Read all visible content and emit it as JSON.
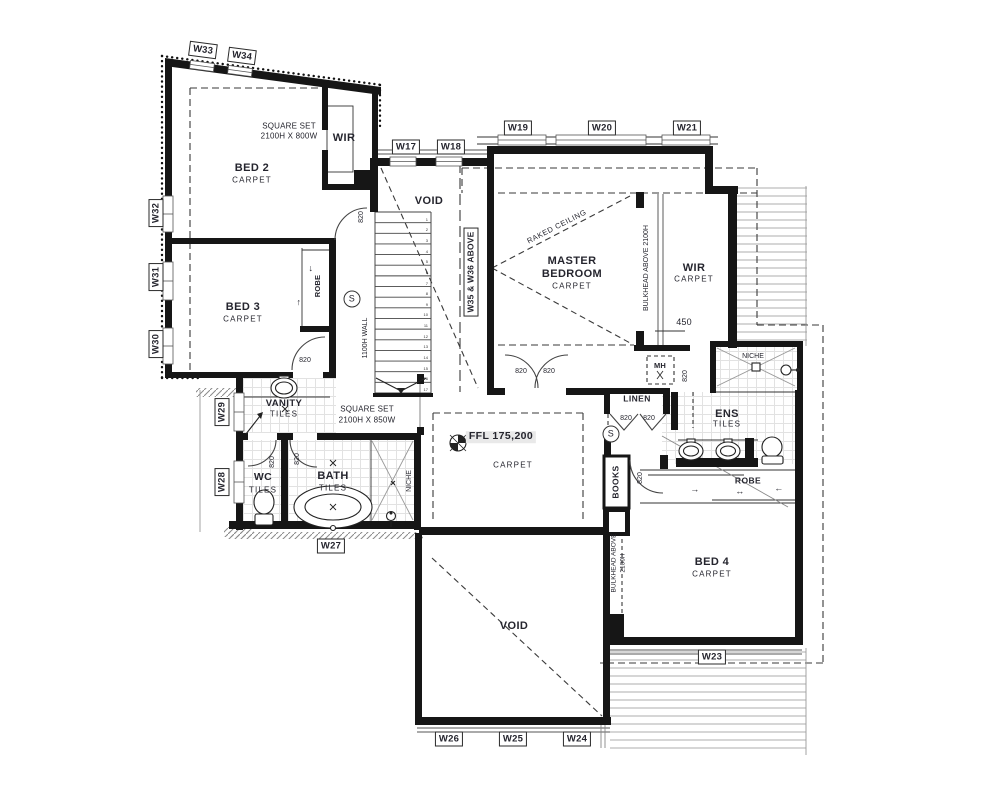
{
  "windows": {
    "w17": "W17",
    "w18": "W18",
    "w19": "W19",
    "w20": "W20",
    "w21": "W21",
    "w23": "W23",
    "w24": "W24",
    "w25": "W25",
    "w26": "W26",
    "w27": "W27",
    "w28": "W28",
    "w29": "W29",
    "w30": "W30",
    "w31": "W31",
    "w32": "W32",
    "w33": "W33",
    "w34": "W34",
    "w35_36_note": "W35 & W36 ABOVE"
  },
  "rooms": {
    "bed2": "BED 2",
    "bed3": "BED 3",
    "bed4": "BED 4",
    "master1": "MASTER",
    "master2": "BEDROOM",
    "wir": "WIR",
    "ens": "ENS",
    "bath": "BATH",
    "wc": "WC",
    "vanity": "VANITY",
    "linen": "LINEN",
    "robe": "ROBE",
    "books": "BOOKS",
    "niche": "NICHE",
    "void": "VOID",
    "mh": "MH"
  },
  "finishes": {
    "carpet": "CARPET",
    "tiles": "TILES"
  },
  "annotations": {
    "square_set_800_l1": "SQUARE SET",
    "square_set_800_l2": "2100H X 800W",
    "square_set_850_l1": "SQUARE SET",
    "square_set_850_l2": "2100H X 850W",
    "raked_ceiling": "RAKED CEILING",
    "bulkhead_full": "BULKHEAD ABOVE 2100H",
    "bulkhead_l1": "BULKHEAD ABOVE",
    "bulkhead_l2": "2100H",
    "wall_1100": "1100H WALL",
    "ffl": "FFL 175,200",
    "dim_450": "450",
    "door_width": "820",
    "smoke_alarm": "S"
  },
  "symbols": {
    "arrow_up": "↑",
    "arrow_down": "↓",
    "arrow_left": "←",
    "arrow_right": "→",
    "arrow_both": "↔"
  },
  "stairs": {
    "tread_count": 17
  },
  "colors": {
    "wall": "#161616",
    "text": "#25252e",
    "hatch": "#a8a8a8",
    "tile": "#e2e2e2",
    "ffl_highlight": "#e9e9e9"
  }
}
